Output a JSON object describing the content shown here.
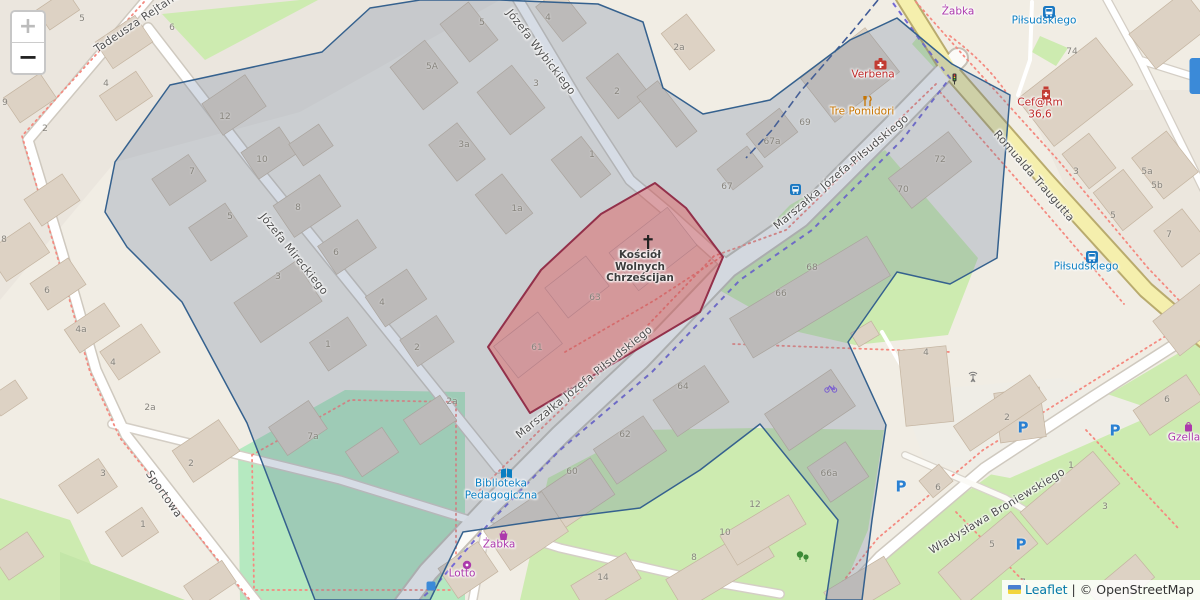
{
  "map": {
    "controls": {
      "zoom_in": "+",
      "zoom_out": "−"
    },
    "attribution": {
      "leaflet": "Leaflet",
      "separator": "|",
      "copyright": "© OpenStreetMap"
    }
  },
  "colors": {
    "highlight_fill": "#e04848",
    "highlight_stroke": "#93304a",
    "overlay_fill": "#5a7396",
    "overlay_stroke": "#35618e",
    "shop_purple": "#ac39ac",
    "food_orange": "#c77400",
    "health_red": "#bf2a2a",
    "transit_blue": "#0a7ec2",
    "parking_blue": "#2a80d2",
    "road_yellow": "#f5efad"
  },
  "streets": [
    {
      "name": "Tadeusza Rejtana",
      "x": 137,
      "y": 22,
      "rot": -34
    },
    {
      "name": "Józefa Wybickiego",
      "x": 541,
      "y": 52,
      "rot": 52
    },
    {
      "name": "Józefa Mireckiego",
      "x": 294,
      "y": 254,
      "rot": 51
    },
    {
      "name": "Sportowa",
      "x": 164,
      "y": 494,
      "rot": 55
    },
    {
      "name": "Marszałka Józefa-Piłsudskiego",
      "x": 841,
      "y": 172,
      "rot": -40
    },
    {
      "name": "Marszałka Józefa Piłsudskiego",
      "x": 584,
      "y": 382,
      "rot": -39
    },
    {
      "name": "Romualda Traugutta",
      "x": 1034,
      "y": 176,
      "rot": 49
    },
    {
      "name": "Władysława Broniewskiego",
      "x": 997,
      "y": 511,
      "rot": -31
    }
  ],
  "pois": [
    {
      "name": "Verbena",
      "lines": [
        "Verbena"
      ],
      "x": 873,
      "y": 75,
      "cls": "red",
      "icon": "firstaid",
      "iconx": 873,
      "icony": 57
    },
    {
      "name": "Tre Pomidori",
      "lines": [
        "Tre Pomidori"
      ],
      "x": 862,
      "y": 112,
      "cls": "orange",
      "icon": "restaurant",
      "iconx": 861,
      "icony": 95
    },
    {
      "name": "Żabka",
      "lines": [
        "Żabka"
      ],
      "x": 958,
      "y": 12,
      "cls": "purple"
    },
    {
      "name": "Piłsudskiego",
      "lines": [
        "Piłsudskiego"
      ],
      "x": 1044,
      "y": 21,
      "cls": "blue",
      "icon": "transit",
      "iconx": 1043,
      "icony": 6
    },
    {
      "name": "Cef@Rm 36,6",
      "lines": [
        "Cef@Rm",
        "36,6"
      ],
      "x": 1040,
      "y": 109,
      "cls": "red",
      "icon": "chemist",
      "iconx": 1040,
      "icony": 86
    },
    {
      "name": "Piłsudskiego",
      "lines": [
        "Piłsudskiego"
      ],
      "x": 1086,
      "y": 267,
      "cls": "blue",
      "icon": "transit",
      "iconx": 1086,
      "icony": 251
    },
    {
      "name": "Biblioteka Pedagogiczna",
      "lines": [
        "Biblioteka",
        "Pedagogiczna"
      ],
      "x": 501,
      "y": 490,
      "cls": "blue",
      "icon": "library",
      "iconx": 500,
      "icony": 467
    },
    {
      "name": "Żabka",
      "lines": [
        "Żabka"
      ],
      "x": 499,
      "y": 545,
      "cls": "purple",
      "icon": "basket",
      "iconx": 497,
      "icony": 529
    },
    {
      "name": "Lotto",
      "lines": [
        "Lotto"
      ],
      "x": 462,
      "y": 574,
      "cls": "purple",
      "icon": "dot",
      "iconx": 462,
      "icony": 560
    },
    {
      "name": "Gzella",
      "lines": [
        "Gzella"
      ],
      "x": 1184,
      "y": 438,
      "cls": "purple",
      "icon": "bag",
      "iconx": 1183,
      "icony": 421
    },
    {
      "name": "Kościół Wolnych Chrześcijan",
      "lines": [
        "Kościół",
        "Wolnych",
        "Chrześcijan"
      ],
      "x": 640,
      "y": 267,
      "cls": "dark",
      "icon": "cross",
      "iconx": 640,
      "icony": 234
    }
  ],
  "map_icons": [
    {
      "type": "bus-stop",
      "x": 790,
      "y": 184
    },
    {
      "type": "traffic-light",
      "x": 951,
      "y": 73
    },
    {
      "type": "antenna",
      "x": 967,
      "y": 371
    },
    {
      "type": "bicycle-parking",
      "x": 824,
      "y": 383
    },
    {
      "type": "trees",
      "x": 795,
      "y": 550
    },
    {
      "type": "parking",
      "x": 1023,
      "y": 428
    },
    {
      "type": "parking",
      "x": 1115,
      "y": 431
    },
    {
      "type": "parking",
      "x": 901,
      "y": 487
    },
    {
      "type": "parking",
      "x": 1021,
      "y": 545
    },
    {
      "type": "poi-blue-partial",
      "x": 1196,
      "y": 76
    },
    {
      "type": "poi-blue-small",
      "x": 431,
      "y": 586
    }
  ],
  "house_numbers": [
    [
      "5",
      82,
      19
    ],
    [
      "6",
      172,
      28
    ],
    [
      "4",
      106,
      84
    ],
    [
      "2",
      45,
      129
    ],
    [
      "9",
      5,
      103
    ],
    [
      "8",
      4,
      240
    ],
    [
      "6",
      47,
      291
    ],
    [
      "4a",
      81,
      330
    ],
    [
      "4",
      113,
      363
    ],
    [
      "3",
      103,
      474
    ],
    [
      "1",
      143,
      525
    ],
    [
      "2",
      191,
      464
    ],
    [
      "2a",
      150,
      408
    ],
    [
      "12",
      225,
      117
    ],
    [
      "10",
      262,
      160
    ],
    [
      "7",
      192,
      172
    ],
    [
      "5",
      230,
      217
    ],
    [
      "8",
      298,
      208
    ],
    [
      "3",
      278,
      277
    ],
    [
      "6",
      336,
      253
    ],
    [
      "4",
      382,
      303
    ],
    [
      "1",
      328,
      345
    ],
    [
      "2",
      417,
      348
    ],
    [
      "2a",
      452,
      402
    ],
    [
      "7a",
      313,
      437
    ],
    [
      "5",
      482,
      23
    ],
    [
      "5A",
      432,
      67
    ],
    [
      "3",
      536,
      84
    ],
    [
      "3a",
      464,
      145
    ],
    [
      "1",
      592,
      155
    ],
    [
      "1a",
      517,
      209
    ],
    [
      "4",
      548,
      18
    ],
    [
      "2",
      617,
      92
    ],
    [
      "2a",
      679,
      48
    ],
    [
      "63",
      595,
      298
    ],
    [
      "61",
      537,
      348
    ],
    [
      "67a",
      772,
      142
    ],
    [
      "69",
      805,
      123
    ],
    [
      "67",
      727,
      187
    ],
    [
      "72",
      940,
      160
    ],
    [
      "70",
      903,
      190
    ],
    [
      "68",
      812,
      268
    ],
    [
      "66",
      781,
      294
    ],
    [
      "4",
      926,
      353
    ],
    [
      "66a",
      829,
      474
    ],
    [
      "12",
      755,
      505
    ],
    [
      "60",
      572,
      472
    ],
    [
      "62",
      625,
      435
    ],
    [
      "64",
      683,
      387
    ],
    [
      "14",
      603,
      578
    ],
    [
      "8",
      694,
      558
    ],
    [
      "10",
      725,
      533
    ],
    [
      "74",
      1072,
      52
    ],
    [
      "3",
      1076,
      172
    ],
    [
      "5a",
      1147,
      172
    ],
    [
      "5b",
      1157,
      186
    ],
    [
      "5",
      1113,
      216
    ],
    [
      "7",
      1169,
      235
    ],
    [
      "6",
      1167,
      400
    ],
    [
      "2",
      1007,
      418
    ],
    [
      "1",
      1071,
      466
    ],
    [
      "3",
      1105,
      507
    ],
    [
      "5",
      992,
      545
    ],
    [
      "7",
      1023,
      583
    ],
    [
      "6",
      938,
      488
    ]
  ]
}
